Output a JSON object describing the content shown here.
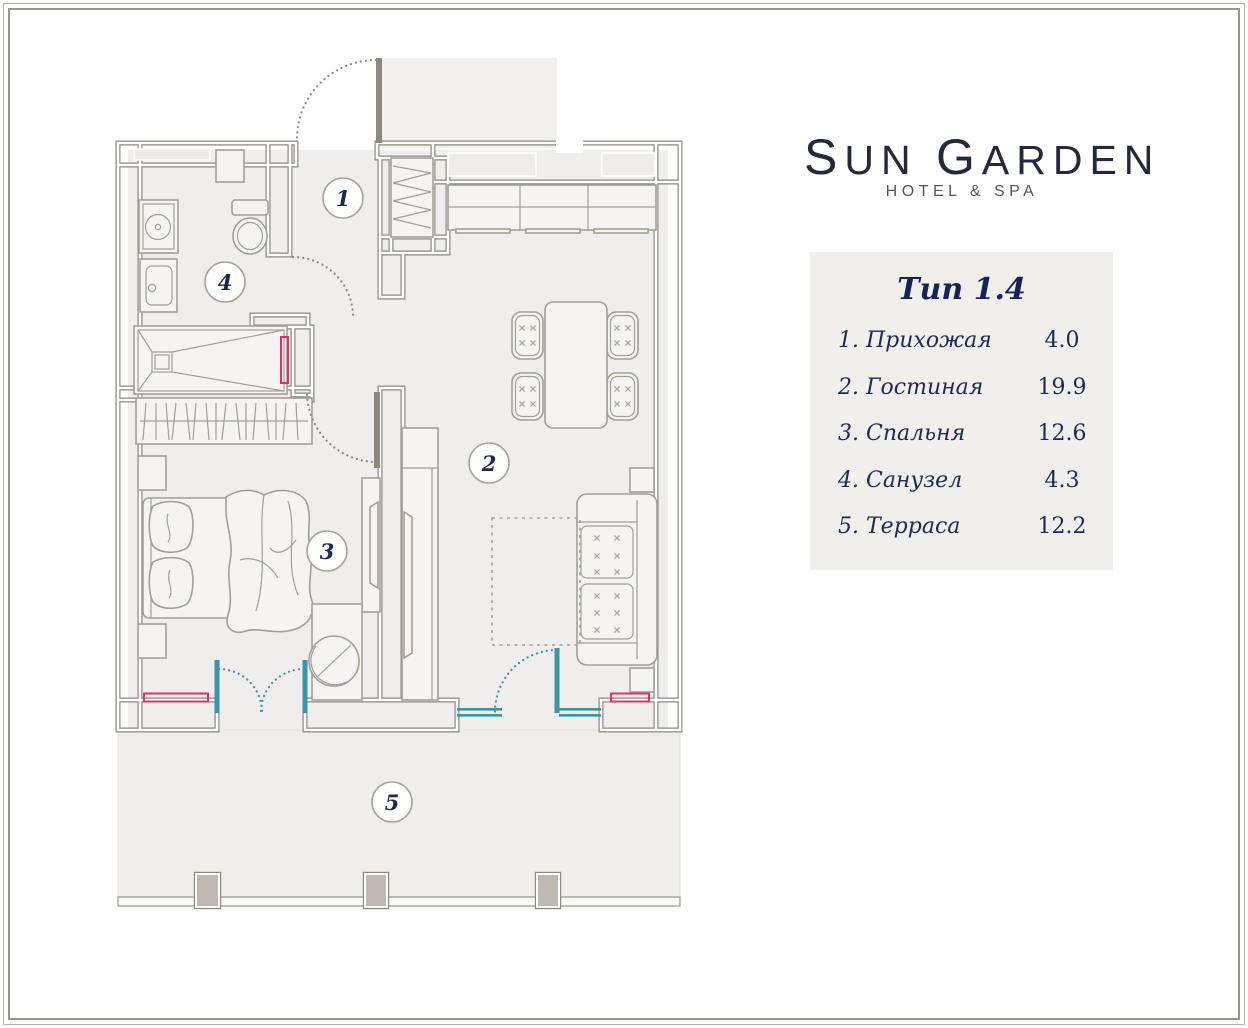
{
  "brand": {
    "initial1": "S",
    "rest1": "UN",
    "initial2": "G",
    "rest2": "ARDEN",
    "tagline": "HOTEL & SPA"
  },
  "legend": {
    "title": "Тип 1.4"
  },
  "rooms": [
    {
      "num": "1",
      "label": "1. Прихожая",
      "area": "4.0"
    },
    {
      "num": "2",
      "label": "2. Гостиная",
      "area": "19.9"
    },
    {
      "num": "3",
      "label": "3. Спальня",
      "area": "12.6"
    },
    {
      "num": "4",
      "label": "4. Санузел",
      "area": "4.3"
    },
    {
      "num": "5",
      "label": "5. Терраса",
      "area": "12.2"
    }
  ],
  "colors": {
    "wall": "#b7b0a9",
    "wall_edge": "#8c857e",
    "floor": "#efeeec",
    "furniture_stroke": "#a59e97",
    "glazing_teal": "#3e93a5",
    "radiator_red": "#d6336b",
    "text_navy": "#1d2a55",
    "legend_bg": "#f0efec"
  }
}
